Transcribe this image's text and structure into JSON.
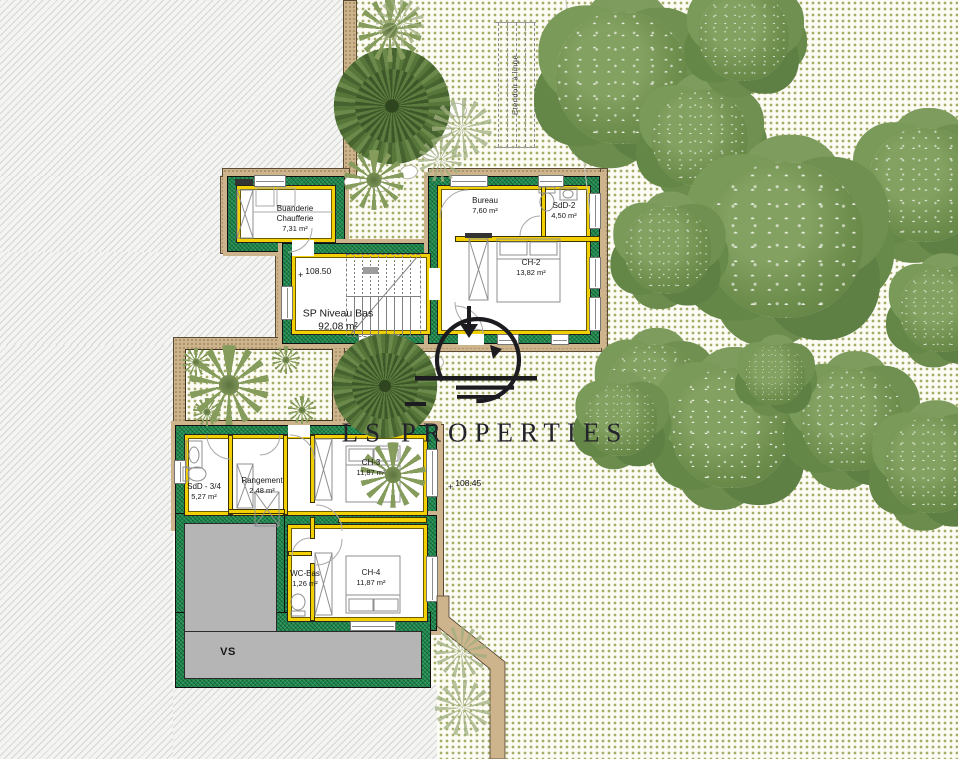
{
  "watermark": {
    "brand": "LS PROPERTIES"
  },
  "level": {
    "name": "SP Niveau Bas",
    "area": "92,08 m²"
  },
  "rooms": [
    {
      "name": "Buanderie\nChaufferie",
      "area": "7,31 m²"
    },
    {
      "name": "Bureau",
      "area": "7,60 m²"
    },
    {
      "name": "SdD-2",
      "area": "4,50 m²"
    },
    {
      "name": "CH-2",
      "area": "13,82 m²"
    },
    {
      "name": "SdD - 3/4",
      "area": "5,27 m²"
    },
    {
      "name": "Rangement",
      "area": "2,48 m²"
    },
    {
      "name": "CH-3",
      "area": "11,87 m²"
    },
    {
      "name": "WC-Bas",
      "area": "1,26 m²"
    },
    {
      "name": "CH-4",
      "area": "11,87 m²"
    },
    {
      "name": "VS",
      "area": ""
    }
  ],
  "markers": [
    {
      "label": "108.50"
    },
    {
      "label": "108.45"
    }
  ],
  "annotations": {
    "etendoir": "Etendoir à linge"
  },
  "icons": {
    "marker_cross": "+"
  },
  "colors": {
    "wall_green": "#1d8b4d",
    "insulation_yellow": "#f3d003",
    "gravel_tan": "#cdb48d",
    "vs_gray": "#b5b5b5",
    "garden_dot_olive": "#a6ad6a",
    "tree_green": "#6d8d4c",
    "watermark_ink": "#23232b"
  }
}
